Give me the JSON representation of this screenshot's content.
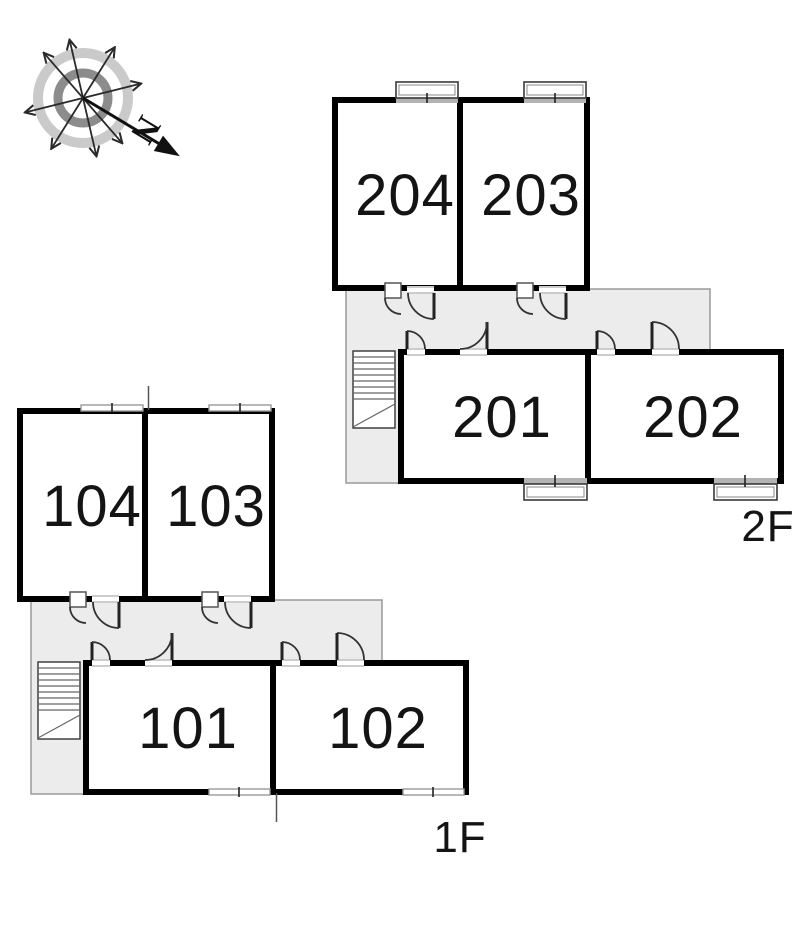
{
  "compass": {
    "north_label": "N"
  },
  "floors": [
    {
      "label": "2F",
      "rooms": [
        {
          "number": "204"
        },
        {
          "number": "203"
        },
        {
          "number": "201"
        },
        {
          "number": "202"
        }
      ]
    },
    {
      "label": "1F",
      "rooms": [
        {
          "number": "104"
        },
        {
          "number": "103"
        },
        {
          "number": "101"
        },
        {
          "number": "102"
        }
      ]
    }
  ],
  "colors": {
    "wall": "#000000",
    "room_fill": "#ffffff",
    "corridor_fill": "#ececec",
    "corridor_outline": "#9a9a9a",
    "window_bar": "#b3b3b3",
    "stair_hatch": "#666666",
    "text": "#141414",
    "compass_ring_outer": "#cacaca",
    "compass_ring_inner": "#8c8c8c"
  }
}
